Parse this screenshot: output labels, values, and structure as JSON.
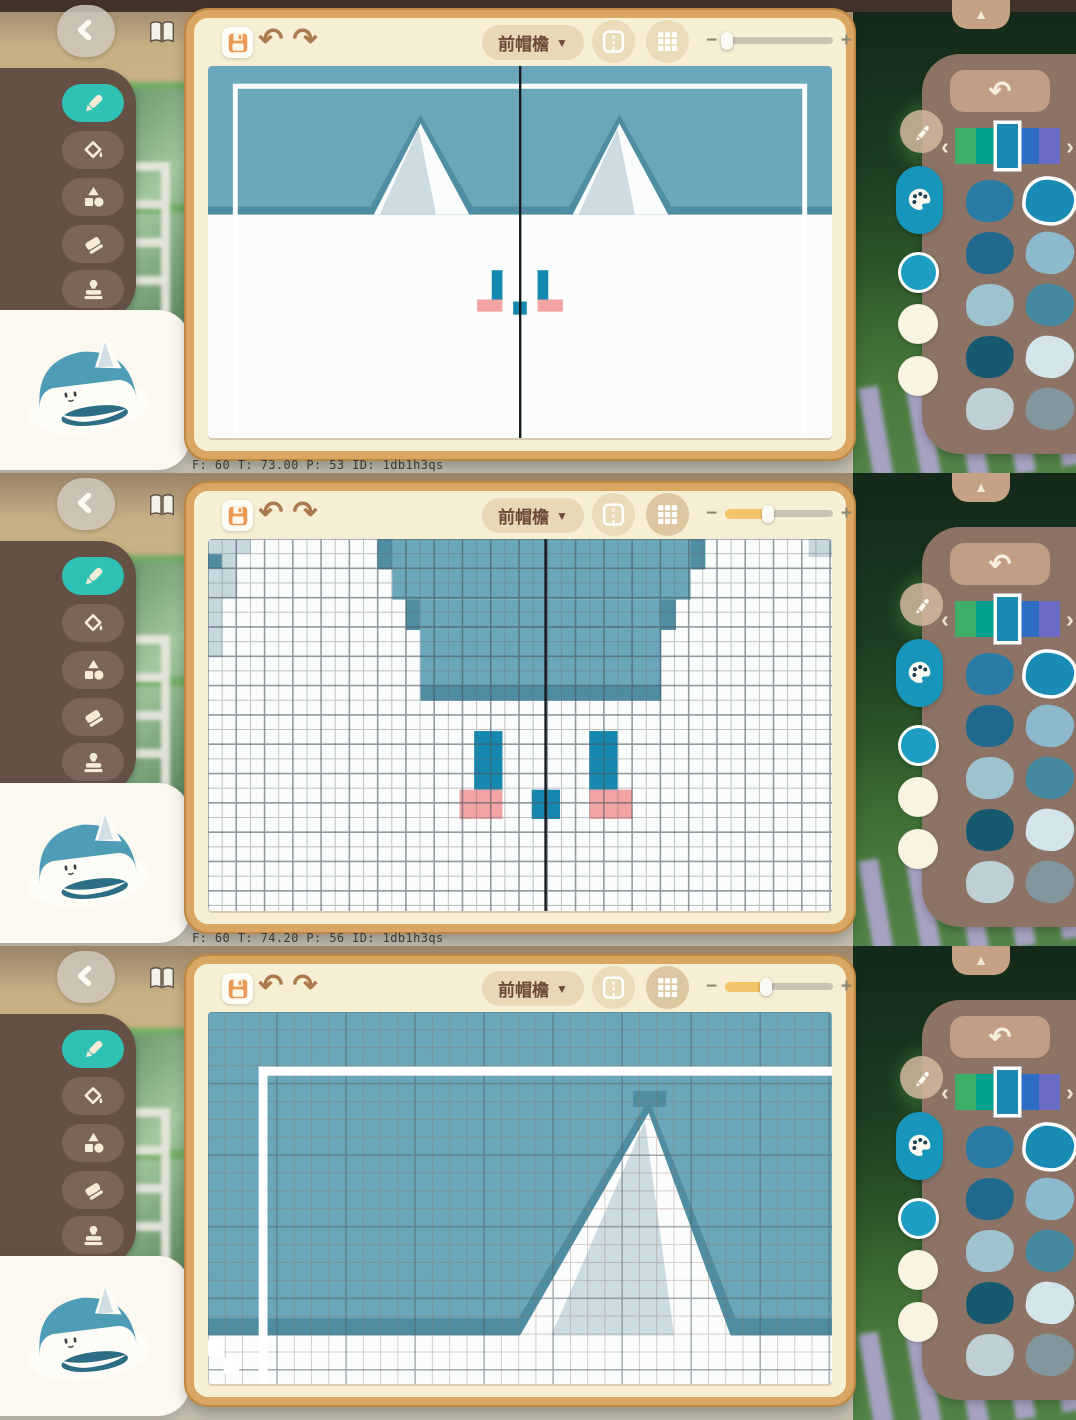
{
  "editor": {
    "section_label": "前帽檐",
    "dropdown_arrow": "▼",
    "zoom_minus": "−",
    "zoom_plus": "+",
    "hue_prev": "‹",
    "hue_next": "›",
    "collapse_arrow": "▲",
    "undo_glyph": "↶",
    "redo_glyph": "↷"
  },
  "tools": {
    "active": "pencil",
    "items": [
      {
        "id": "pencil",
        "icon": "pencil-icon"
      },
      {
        "id": "fill",
        "icon": "paint-bucket-icon"
      },
      {
        "id": "shapes",
        "icon": "shapes-icon"
      },
      {
        "id": "eraser",
        "icon": "eraser-icon"
      },
      {
        "id": "stamp",
        "icon": "stamp-icon"
      }
    ]
  },
  "palette": {
    "hue_segments": [
      "#3fae69",
      "#00a08e",
      "#1a89b4",
      "#2e6ec2",
      "#6c6cc6"
    ],
    "selected_hue_index": 2,
    "current_color": "#1f9ec4",
    "recent_colors": [
      "#f8f3e2",
      "#f8f3e2"
    ],
    "swatches": [
      [
        "#2a7ca6",
        "#188cb4"
      ],
      [
        "#20688c",
        "#8cbacc"
      ],
      [
        "#9fc2cf",
        "#44899f"
      ],
      [
        "#175a70",
        "#d3e5ea"
      ],
      [
        "#bed0d6",
        "#83969e"
      ]
    ],
    "selected_swatch": [
      0,
      1
    ]
  },
  "design_colors": {
    "teal_bg": "#6aa7ba",
    "teal_dark": "#4e8da2",
    "ear_shade": "#ccdce2",
    "white": "#fbfdfc",
    "eye_teal": "#1488ae",
    "blush_pink": "#f2a3a3"
  },
  "frames": [
    {
      "stats": "F: 60   T: 73.00   P: 53   ID: 1db1h3qs",
      "slider": 0.02,
      "grid_on": false,
      "canvas": {
        "shapes": [
          [
            "r",
            0,
            0,
            640,
            368,
            "#fbfdfc"
          ],
          [
            "r",
            0,
            0,
            640,
            146,
            "#6aa7ba"
          ],
          [
            "r",
            0,
            139,
            640,
            8,
            "#4e8da2"
          ],
          [
            "p",
            "162,147 218,48 276,147",
            "#4e8da2"
          ],
          [
            "p",
            "170,147 218,57 268,147",
            "#fbfdfc"
          ],
          [
            "p",
            "176,147 216,62 234,147",
            "#ccdce2"
          ],
          [
            "p",
            "366,147 422,48 480,147",
            "#4e8da2"
          ],
          [
            "p",
            "374,147 422,57 472,147",
            "#fbfdfc"
          ],
          [
            "p",
            "380,147 420,62 438,147",
            "#ccdce2"
          ],
          [
            "r",
            291,
            202,
            11,
            30,
            "#1488ae"
          ],
          [
            "r",
            338,
            202,
            11,
            30,
            "#1488ae"
          ],
          [
            "r",
            276,
            231,
            26,
            12,
            "#f2a3a3"
          ],
          [
            "r",
            338,
            231,
            26,
            12,
            "#f2a3a3"
          ],
          [
            "r",
            313,
            233,
            14,
            13,
            "#1488ae"
          ]
        ],
        "overlays": [
          [
            "s",
            28,
            20,
            584,
            420,
            "#ffffff",
            5
          ]
        ],
        "grid": null,
        "mirror_x": 320
      }
    },
    {
      "stats": "F: 60   T: 74.20   P: 56   ID: 1db1h3qs",
      "slider": 0.4,
      "grid_on": true,
      "canvas": {
        "shapes": [
          [
            "r",
            0,
            0,
            640,
            368,
            "#fbfdfc"
          ],
          [
            "r",
            174,
            0,
            336,
            30,
            "#6aa7ba"
          ],
          [
            "r",
            189,
            30,
            306,
            30,
            "#6aa7ba"
          ],
          [
            "r",
            203,
            60,
            277,
            30,
            "#6aa7ba"
          ],
          [
            "r",
            218,
            90,
            247,
            56,
            "#6aa7ba"
          ],
          [
            "r",
            218,
            145,
            247,
            15,
            "#4e8da2"
          ],
          [
            "r",
            174,
            0,
            15,
            30,
            "#4e8da2"
          ],
          [
            "r",
            495,
            0,
            15,
            30,
            "#4e8da2"
          ],
          [
            "r",
            203,
            60,
            14,
            30,
            "#4e8da2"
          ],
          [
            "r",
            465,
            60,
            15,
            30,
            "#4e8da2"
          ],
          [
            "r",
            0,
            0,
            44,
            15,
            "#c6d8de"
          ],
          [
            "r",
            0,
            15,
            30,
            44,
            "#c6d8de"
          ],
          [
            "r",
            0,
            59,
            15,
            58,
            "#c6d8de"
          ],
          [
            "r",
            0,
            15,
            14,
            14,
            "#4e8da2"
          ],
          [
            "r",
            616,
            0,
            24,
            18,
            "#c6d8de"
          ],
          [
            "r",
            273,
            190,
            29,
            58,
            "#1488ae"
          ],
          [
            "r",
            391,
            190,
            29,
            58,
            "#1488ae"
          ],
          [
            "r",
            258,
            248,
            44,
            29,
            "#f2a3a3"
          ],
          [
            "r",
            391,
            248,
            44,
            29,
            "#f2a3a3"
          ],
          [
            "r",
            332,
            248,
            29,
            29,
            "#1488ae"
          ]
        ],
        "overlays": [],
        "grid": {
          "cell": 14.5,
          "every": 2,
          "minor": "rgba(104,112,122,0.42)",
          "major": "rgba(76,86,98,0.6)"
        },
        "mirror_x": 346
      }
    },
    {
      "stats": "",
      "slider": 0.38,
      "grid_on": true,
      "canvas": {
        "shapes": [
          [
            "r",
            0,
            0,
            640,
            368,
            "#6aa7ba"
          ],
          [
            "r",
            0,
            303,
            640,
            17,
            "#4e8da2"
          ],
          [
            "r",
            0,
            320,
            640,
            48,
            "#fbfdfc"
          ],
          [
            "p",
            "308,320 452,86 548,320",
            "#4e8da2"
          ],
          [
            "p",
            "320,320 452,100 536,320",
            "#fbfdfc"
          ],
          [
            "p",
            "352,320 448,108 478,320",
            "#ccdce2"
          ],
          [
            "r",
            436,
            78,
            34,
            16,
            "#4e8da2"
          ]
        ],
        "overlays": [
          [
            "r",
            52,
            54,
            588,
            9,
            "#ffffff"
          ],
          [
            "r",
            52,
            54,
            9,
            314,
            "#ffffff"
          ],
          [
            "r",
            0,
            324,
            16,
            16,
            "#ffffff"
          ],
          [
            "r",
            16,
            342,
            16,
            16,
            "#ffffff"
          ]
        ],
        "grid": {
          "cell": 17.7,
          "every": 4,
          "minor": "rgba(150,112,104,0.35)",
          "major": "rgba(84,100,108,0.5)"
        },
        "mirror_x": null
      }
    }
  ]
}
